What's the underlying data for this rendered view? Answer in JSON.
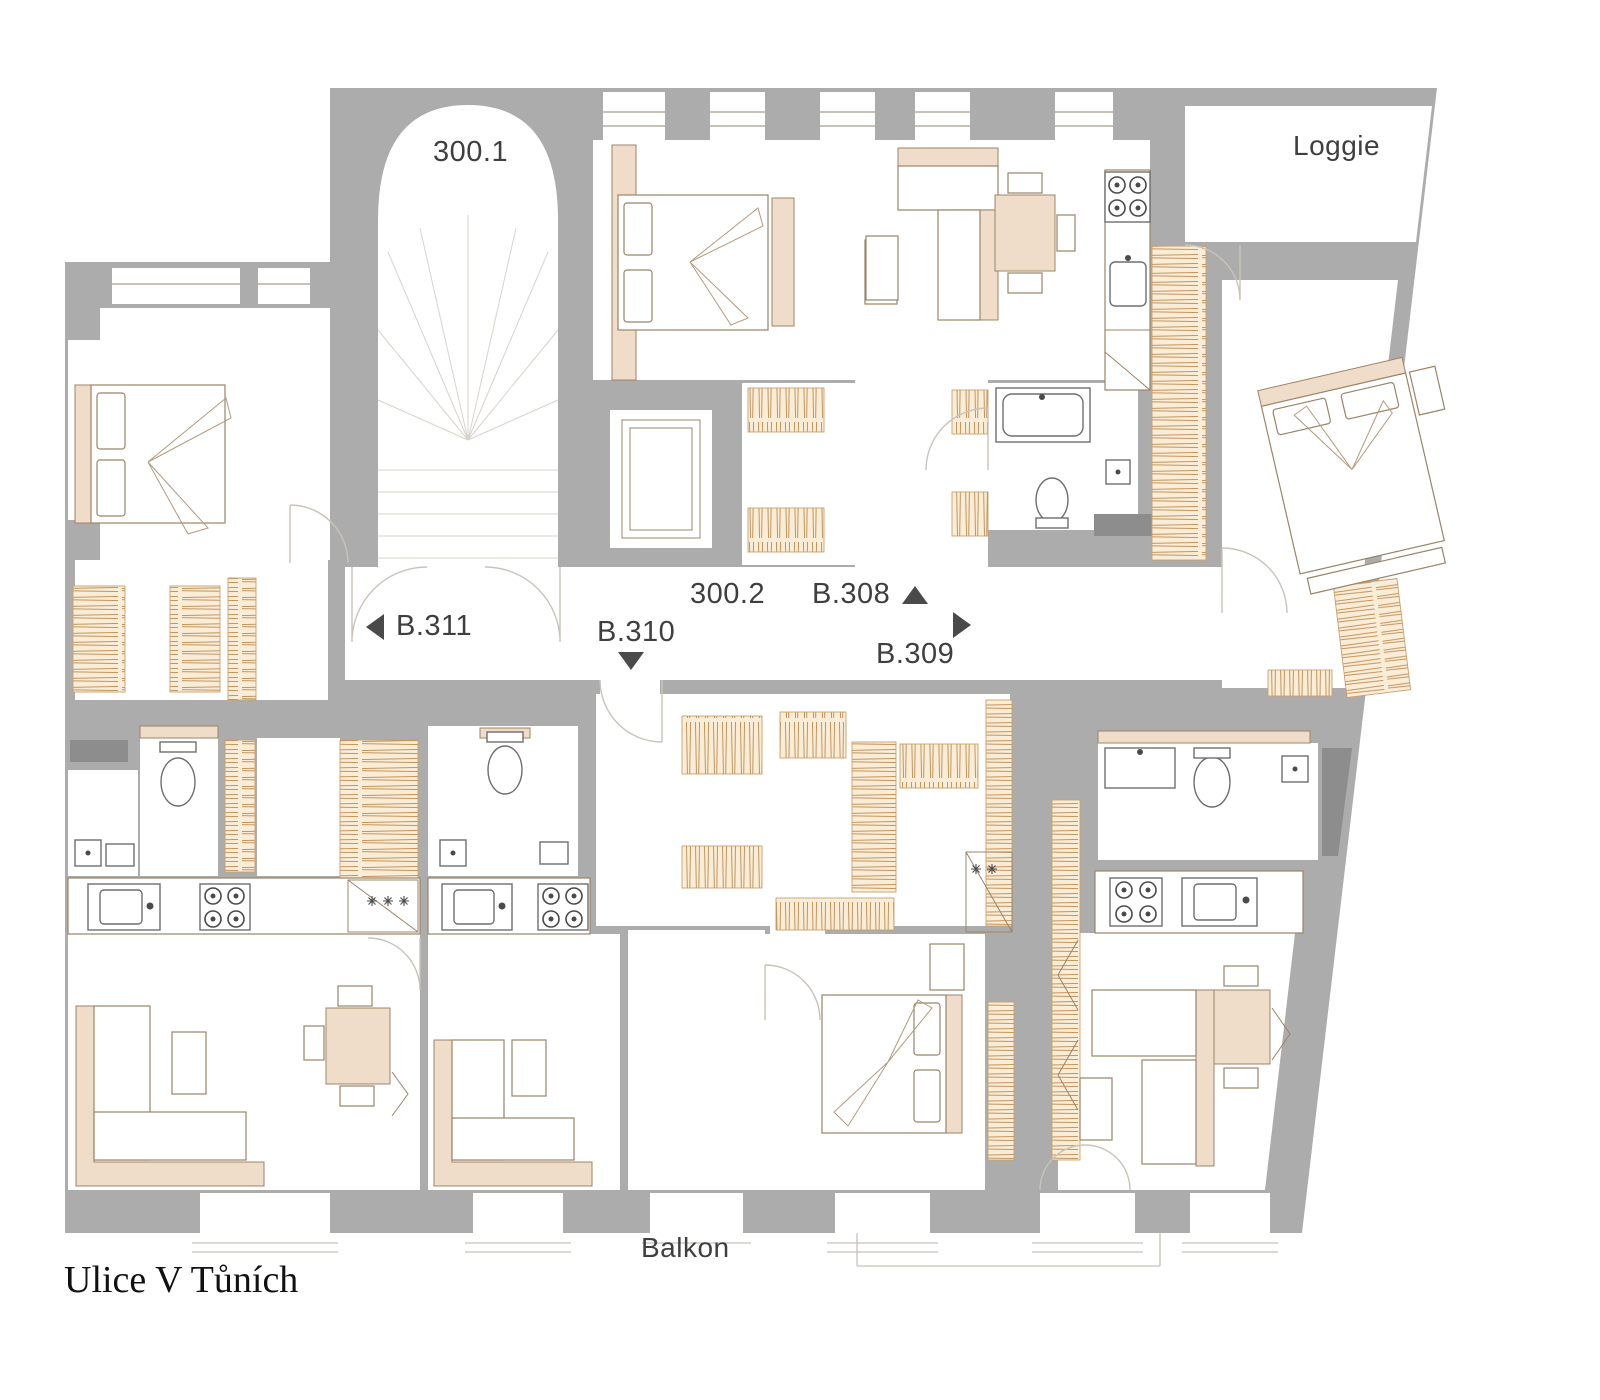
{
  "labels": {
    "staircase": "300.1",
    "corridor": "300.2",
    "loggia": "Loggie",
    "balcony": "Balkon",
    "street": "Ulice V Tůních"
  },
  "units": [
    {
      "id": "B.311",
      "arrow": "left"
    },
    {
      "id": "B.310",
      "arrow": "down"
    },
    {
      "id": "B.308",
      "arrow": "up"
    },
    {
      "id": "B.309",
      "arrow": "right"
    }
  ],
  "colors": {
    "wall": "#acacac",
    "shaft": "#8d8d8d",
    "room": "#ffffff",
    "furniture_accent": "#f0ddc9",
    "wardrobe_fill": "#f9edd8",
    "wardrobe_line": "#c08a4e",
    "outline": "#9b8468",
    "door_arc": "#c9c3ba",
    "label_text": "#3f3f3f",
    "street_text": "#111111"
  }
}
